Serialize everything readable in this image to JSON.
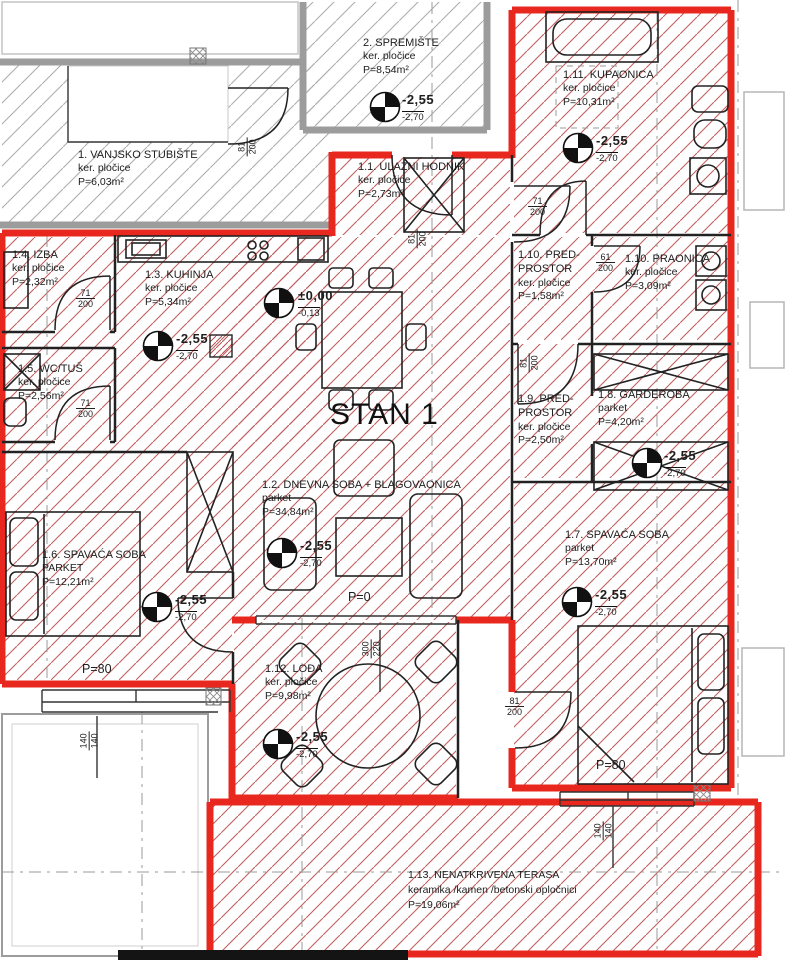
{
  "title": "STAN 1",
  "colors": {
    "wall_red": "#e8281e",
    "hatch_red": "#c06060",
    "wall_gray": "#9c9c9c",
    "line_black": "#1d1d1d"
  },
  "rooms": {
    "stubiste": {
      "name": "1. VANJSKO STUBIŠTE",
      "material": "ker. pločice",
      "area": "P=6,03m²"
    },
    "spremiste": {
      "name": "2. SPREMIŠTE",
      "material": "ker. pločice",
      "area": "P=8,54m²",
      "lvl": "-2,55",
      "lvl2": "-2,70"
    },
    "kupaonica": {
      "name": "1.11. KUPAONICA",
      "material": "ker. pločice",
      "area": "P=10,31m²",
      "lvl": "-2,55",
      "lvl2": "-2,70"
    },
    "hodnik": {
      "name": "1.1. ULAZNI HODNIK",
      "material": "ker. pločice",
      "area": "P=2,73m²"
    },
    "izba": {
      "name": "1.4. IZBA",
      "material": "ker. pločice",
      "area": "P=2,32m²"
    },
    "kuhinja": {
      "name": "1.3. KUHINJA",
      "material": "ker. pločice",
      "area": "P=5,34m²",
      "lvl": "-2,55",
      "lvl2": "-2,70",
      "lvl0": "±0,00",
      "lvl0b": "-0,13"
    },
    "wctus": {
      "name": "1.5. WC/TUŠ",
      "material": "ker. pločice",
      "area": "P=2,56m²"
    },
    "pred110": {
      "name": "1.10. PRED-PROSTOR",
      "material": "ker. pločice",
      "area": "P=1,58m²"
    },
    "praonica": {
      "name": "1.10. PRAONICA",
      "material": "ker. pločice",
      "area": "P=3,09m²"
    },
    "pred19": {
      "name": "1.9. PRED-PROSTOR",
      "material": "ker. pločice",
      "area": "P=2,50m²"
    },
    "garderoba": {
      "name": "1.8. GARDEROBA",
      "material": "parket",
      "area": "P=4,20m²",
      "lvl": "-2,55",
      "lvl2": "-2,70"
    },
    "dnevna": {
      "name": "1.2. DNEVNA SOBA + BLAGOVAONICA",
      "material": "parket",
      "area": "P=34,84m²",
      "lvl": "-2,55",
      "lvl2": "-2,70"
    },
    "spavaca6": {
      "name": "1.6. SPAVAĆA SOBA",
      "material": "PARKET",
      "area": "P=12,21m²",
      "lvl": "-2,55",
      "lvl2": "-2,70"
    },
    "spavaca7": {
      "name": "1.7. SPAVAĆA SOBA",
      "material": "parket",
      "area": "P=13,70m²",
      "lvl": "-2,55",
      "lvl2": "-2,70"
    },
    "loda": {
      "name": "1.12. LOĐA",
      "material": "ker. pločice",
      "area": "P=9,98m²",
      "lvl": "-2,55",
      "lvl2": "-2,70"
    },
    "terasa": {
      "name": "1.13. NENATKRIVENA TERASA",
      "material": "keramika /kamen /betonski opločnici",
      "area": "P=19,06m²"
    }
  },
  "dims": {
    "d81": "81",
    "d71": "71",
    "d61": "61",
    "d200": "200",
    "d300": "300",
    "d220": "220",
    "d140": "140"
  },
  "marks": {
    "p0": "P=0",
    "p80": "P=80"
  }
}
